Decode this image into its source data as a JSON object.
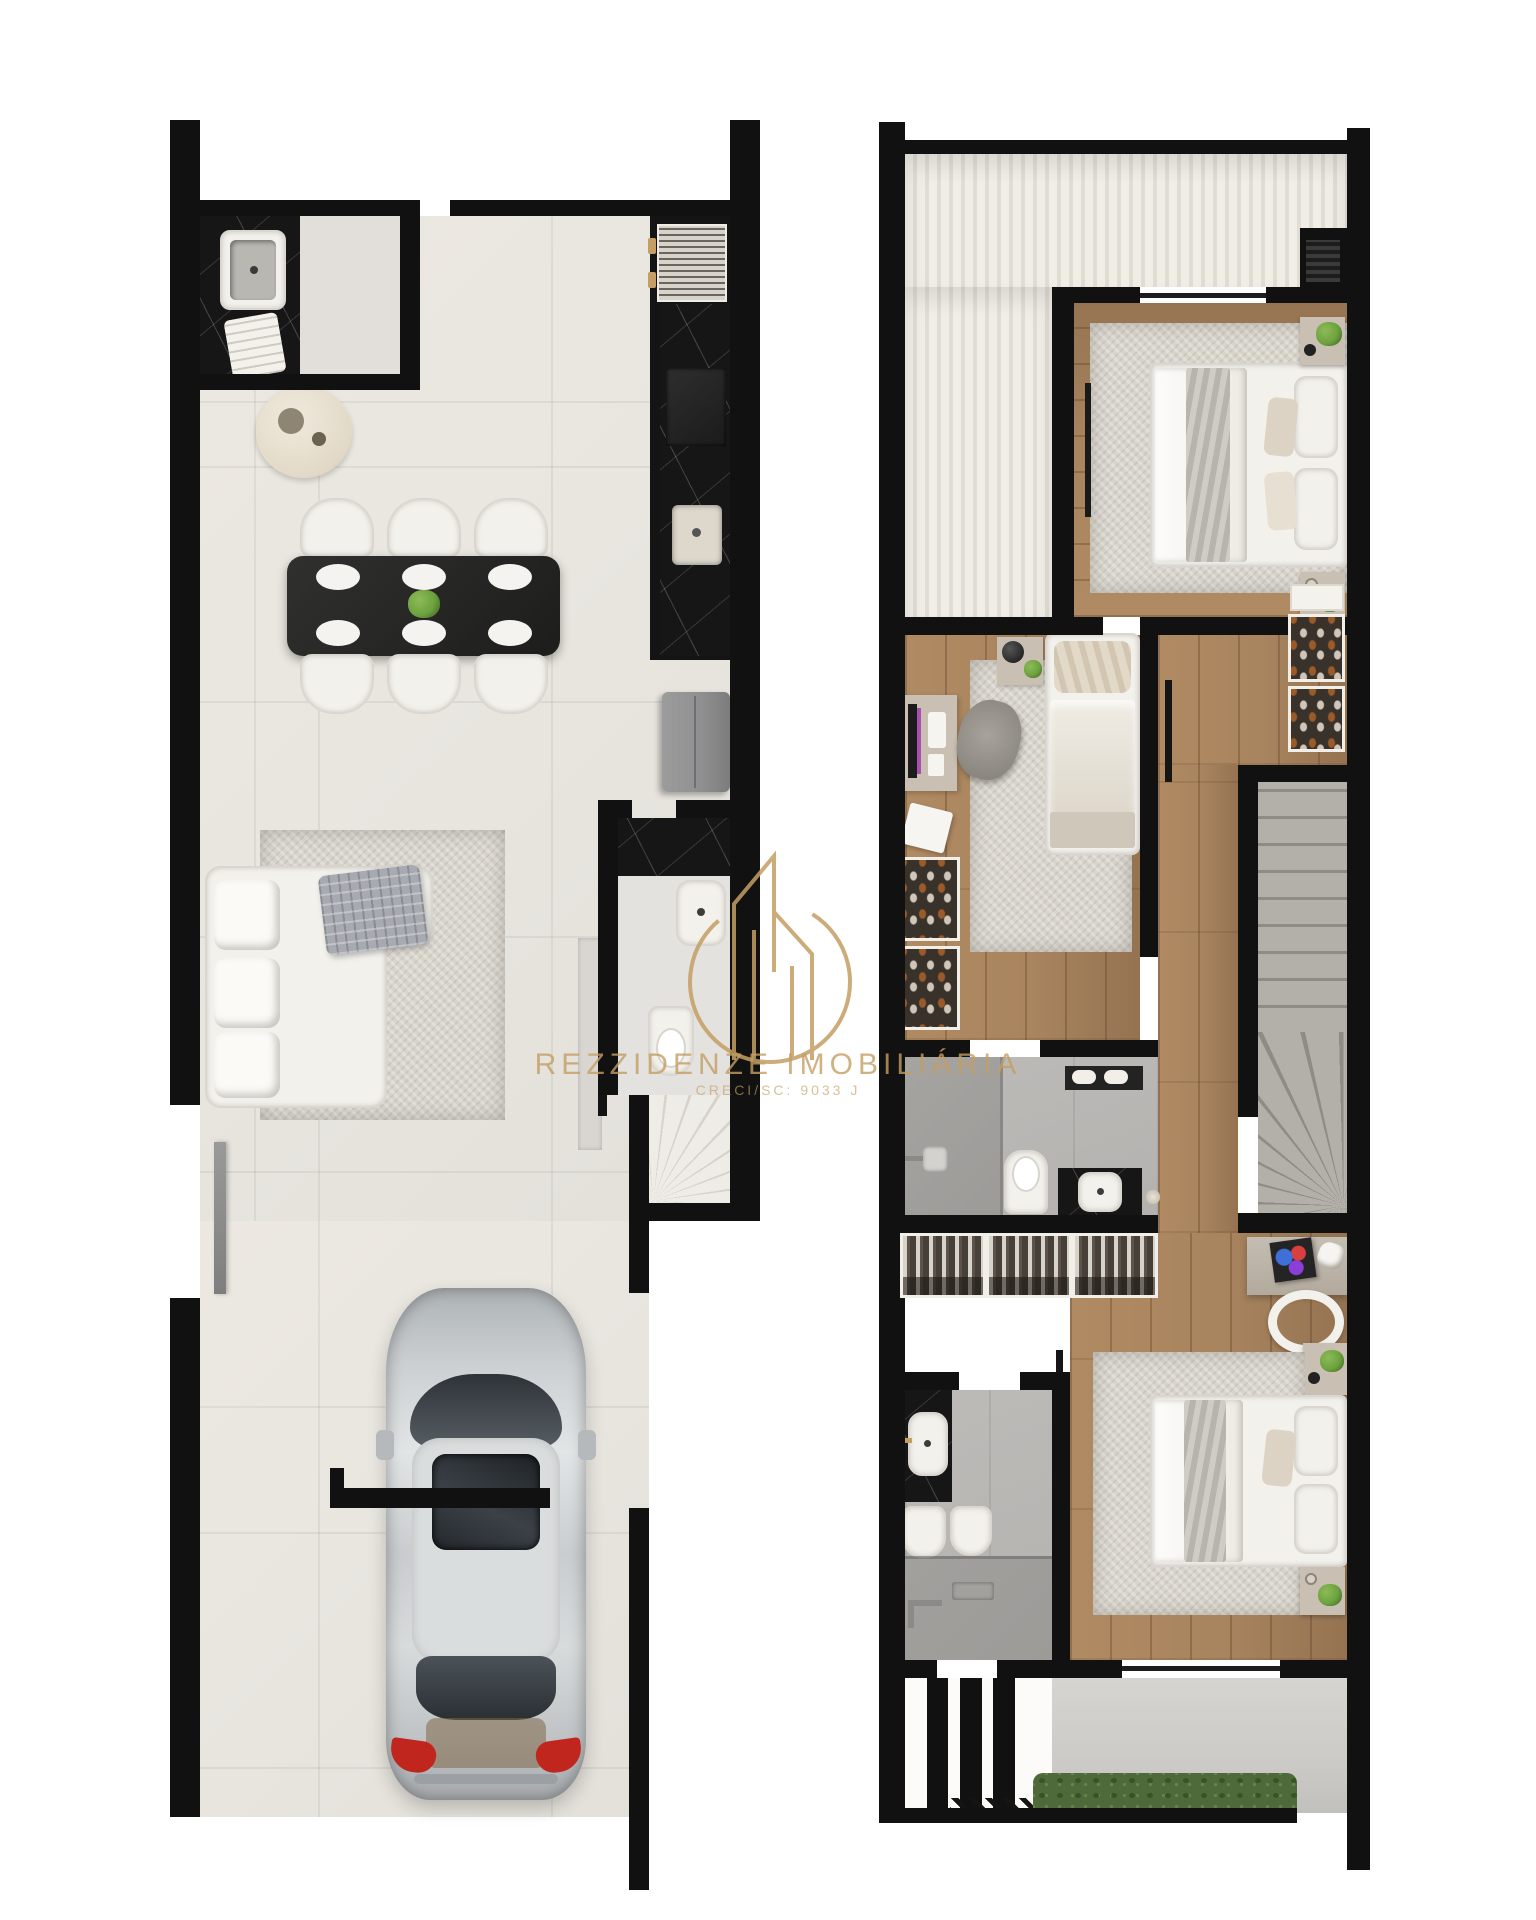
{
  "watermark": {
    "brand": "REZZIDENZE IMOBILIÁRIA",
    "license": "CRECI/SC: 9033 J"
  },
  "plans": {
    "ground_floor": {
      "name": "ground-floor-plan",
      "rooms": [
        "laundry",
        "kitchen",
        "dining-room",
        "living-room",
        "half-bathroom",
        "stairs",
        "garage"
      ],
      "furniture": [
        "laundry-sink",
        "round-planter",
        "vent-grill",
        "cooktop",
        "kitchen-sink",
        "fridge",
        "dining-table-6-chairs",
        "l-shaped-sofa",
        "area-rug",
        "tv-panel",
        "toilet",
        "vanity-sink",
        "winder-stairs",
        "silver-car",
        "side-entry-door"
      ]
    },
    "upper_floor": {
      "name": "upper-floor-plan",
      "rooms": [
        "roof-terrace",
        "master-bedroom",
        "bedroom-2-office",
        "hallway",
        "bathroom",
        "closet-niche",
        "stairwell",
        "desk-nook",
        "bedroom-3",
        "bathroom-2",
        "balcony-garden"
      ],
      "furniture": [
        "double-bed",
        "nightstands",
        "wardrobe-door",
        "ac-unit",
        "desk-with-monitor",
        "office-chair",
        "single-bed",
        "shoe-closets",
        "hanging-clothes-rack",
        "shower",
        "toilet",
        "vanity-basin",
        "stairs",
        "art-desk",
        "white-chair",
        "double-bed-2",
        "toilet-and-bidet",
        "hedge",
        "privacy-slats"
      ]
    }
  },
  "colors": {
    "wall": "#111111",
    "gold": "#c49e63",
    "tile": "#e9e6e0",
    "wood": "#a8845f",
    "rug": "#d8d4cc",
    "white": "#f3f1ec",
    "marble": "#161616",
    "graytile": "#b4b2af",
    "shower": "#9d9b98",
    "concrete": "#cdcbc7",
    "slat_a": "#f1eee8",
    "slat_b": "#e1ddd4",
    "stair_light": "#eeece7",
    "stair_gray": "#b3afa9",
    "stair_dark": "#8f8b85",
    "hedge": "#4e6a3a",
    "car": "#c8ccce",
    "glass": "#2e3338",
    "red": "#c0261d",
    "fridge": "#8f8f90",
    "purple": "#a94fae",
    "green": "#6da23f",
    "throw": "#a7abb1",
    "furn": "#c9c0b3"
  }
}
